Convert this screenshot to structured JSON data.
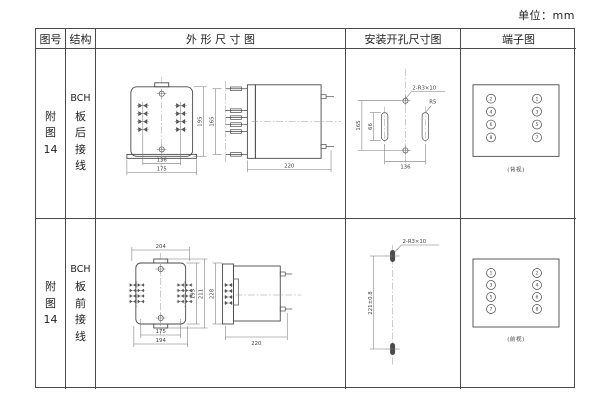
{
  "unit_label": "单位：mm",
  "table": {
    "headers": [
      "图号",
      "结构",
      "外 形 尺 寸 图",
      "安装开孔尺寸图",
      "端子图"
    ],
    "rows": [
      {
        "figure_no": [
          "附",
          "图",
          "14"
        ],
        "structure": [
          "BCH",
          "板",
          "后",
          "接",
          "线"
        ],
        "outline": {
          "front": {
            "w_inner": "136",
            "w_outer": "175",
            "h": "195"
          },
          "side": {
            "h": "165",
            "d": "220"
          }
        },
        "install": {
          "h": "165",
          "slot": "66",
          "w": "136",
          "slot_label": "2-R3×10",
          "radius_label": "R5"
        },
        "terminals": {
          "left": [
            "2",
            "4",
            "6",
            "8"
          ],
          "right": [
            "1",
            "3",
            "5",
            "7"
          ],
          "caption": "(背视)"
        }
      },
      {
        "figure_no": [
          "附",
          "图",
          "14"
        ],
        "structure": [
          "BCH",
          "板",
          "前",
          "接",
          "线"
        ],
        "outline": {
          "front": {
            "top": "204",
            "h_inner": "195",
            "h_outer": "211",
            "b_inner": "175",
            "b_outer": "194"
          },
          "side": {
            "h": "228",
            "d": "220"
          }
        },
        "install": {
          "h": "221±0.8",
          "slot_label": "2-R3×10"
        },
        "terminals": {
          "left": [
            "1",
            "3",
            "5",
            "7"
          ],
          "right": [
            "2",
            "4",
            "6",
            "8"
          ],
          "caption": "(前视)"
        }
      }
    ]
  }
}
